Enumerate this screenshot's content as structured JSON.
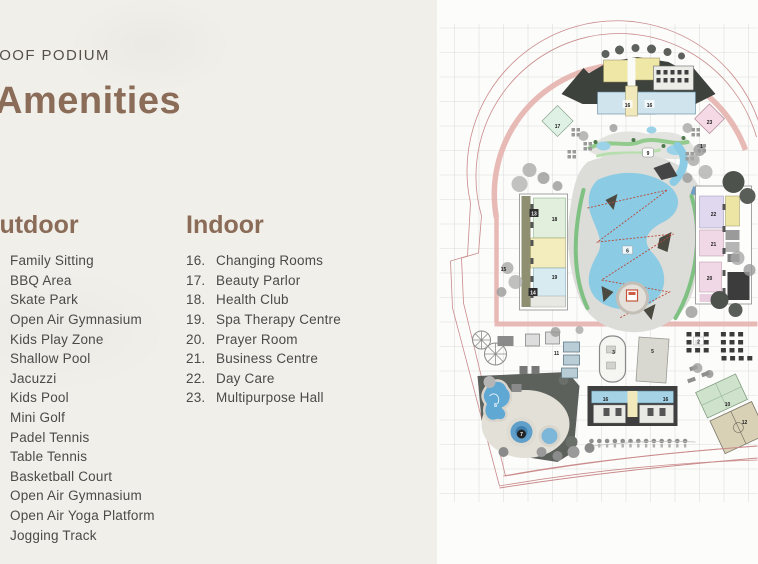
{
  "header": {
    "eyebrow": "ROOF PODIUM",
    "title": "Amenities"
  },
  "outdoor": {
    "heading": "Outdoor",
    "items": [
      "Family Sitting",
      "BBQ Area",
      "Skate Park",
      "Open Air Gymnasium",
      "Kids Play Zone",
      "Shallow Pool",
      "Jacuzzi",
      "Kids Pool",
      "Mini Golf",
      "Padel Tennis",
      "Table Tennis",
      "Basketball Court",
      "Open Air Gymnasium",
      "Open Air Yoga Platform",
      "Jogging Track"
    ]
  },
  "indoor": {
    "heading": "Indoor",
    "items": [
      {
        "num": "16.",
        "label": "Changing Rooms"
      },
      {
        "num": "17.",
        "label": "Beauty Parlor"
      },
      {
        "num": "18.",
        "label": "Health Club"
      },
      {
        "num": "19.",
        "label": "Spa Therapy Centre"
      },
      {
        "num": "20.",
        "label": "Prayer Room"
      },
      {
        "num": "21.",
        "label": "Business Centre"
      },
      {
        "num": "22.",
        "label": "Day Care"
      },
      {
        "num": "23.",
        "label": "Multipurpose Hall"
      }
    ]
  },
  "plan": {
    "labels": [
      {
        "n": "17"
      },
      {
        "n": "23"
      },
      {
        "n": "16"
      },
      {
        "n": "16"
      },
      {
        "n": "13"
      },
      {
        "n": "18"
      },
      {
        "n": "19"
      },
      {
        "n": "14"
      },
      {
        "n": "22"
      },
      {
        "n": "21"
      },
      {
        "n": "20"
      },
      {
        "n": "6"
      },
      {
        "n": "9"
      },
      {
        "n": "8"
      },
      {
        "n": "7"
      },
      {
        "n": "3"
      },
      {
        "n": "5"
      },
      {
        "n": "11"
      },
      {
        "n": "2"
      },
      {
        "n": "10"
      },
      {
        "n": "12"
      },
      {
        "n": "16"
      },
      {
        "n": "16"
      },
      {
        "n": "15"
      },
      {
        "n": "1"
      }
    ],
    "colors": {
      "accent_brown": "#8a6c58",
      "boundary_pink": "#c98a8a",
      "walkway_pink": "#e6b2ae",
      "water_blue": "#8ccbe4"
    }
  }
}
